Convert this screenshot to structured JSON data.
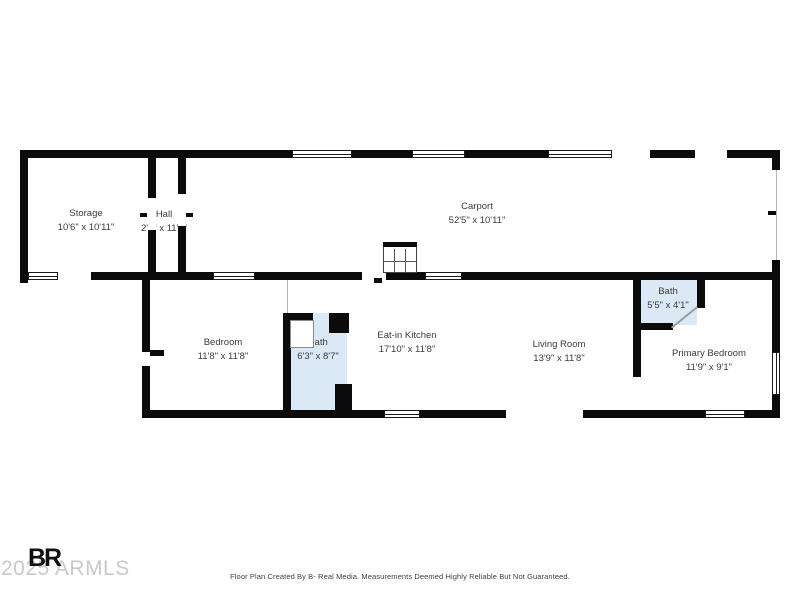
{
  "rooms": [
    {
      "name": "Storage",
      "dims": "10'6\" x 10'11\""
    },
    {
      "name": "Hall",
      "dims": "2'8\" x 11'0\""
    },
    {
      "name": "Carport",
      "dims": "52'5\" x 10'11\""
    },
    {
      "name": "Bedroom",
      "dims": "11'8\" x 11'8\""
    },
    {
      "name": "Bath",
      "dims": "6'3\" x 8'7\""
    },
    {
      "name": "Eat-in Kitchen",
      "dims": "17'10\" x 11'8\""
    },
    {
      "name": "Living Room",
      "dims": "13'9\" x 11'8\""
    },
    {
      "name": "Bath",
      "dims": "5'5\" x 4'1\""
    },
    {
      "name": "Primary Bedroom",
      "dims": "11'9\" x 9'1\""
    }
  ],
  "watermark": {
    "logo": "BR",
    "year_text": "2025 ARMLS"
  },
  "footer": {
    "text": "Floor Plan Created By B- Real Media. Measurements Deemed Highly Reliable But Not Guaranteed."
  },
  "colors": {
    "wall": "#0b0b0b",
    "bath_fill": "#dbe9f7",
    "label": "#3a3a3a",
    "watermark": "#c9c9c9"
  }
}
